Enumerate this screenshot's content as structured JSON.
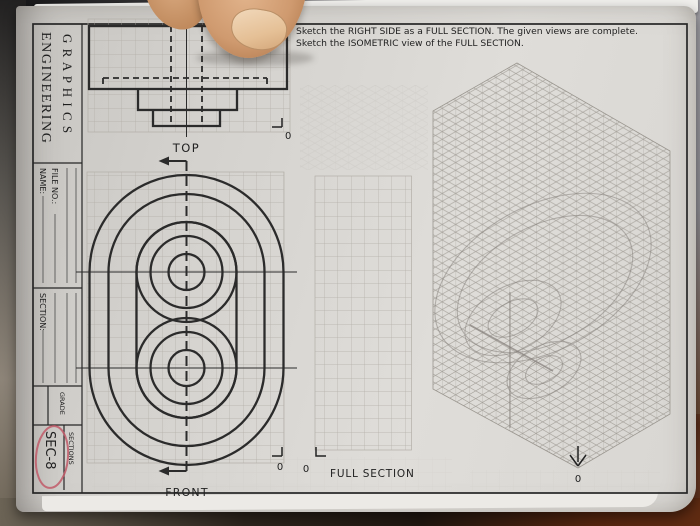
{
  "scene": {
    "kind": "photo of an engineering graphics worksheet page held open by a fingertip",
    "table_colors": {
      "top_left_dark": "#1a191b",
      "left_gray": "#6f6b66",
      "right_gray": "#a8a7ac",
      "bottom_brown": "#5f2b12",
      "bottom_dark": "#241b13"
    },
    "finger": {
      "skin": "#cf9a6f",
      "skin_light": "#e2b48c",
      "nail": "#eed6b8"
    }
  },
  "sheet": {
    "paper_color": "#d9d7d3",
    "border_color": "#262626",
    "line_color": "#2b2b2b",
    "grid_color": "#b2aea7",
    "iso_grid_color": "#a29e97",
    "pencil_color": "#837e79",
    "instructions": {
      "line1": "Sketch the RIGHT SIDE as a FULL SECTION.  The given views are complete.",
      "line2": "Sketch the ISOMETRIC view of the FULL SECTION."
    },
    "title_block": {
      "title_line1": "ENGINEERING",
      "title_line2": "G R A P H I C S",
      "name_label": "NAME:",
      "file_no_label": "FILE NO.:",
      "section_label": "SECTION:",
      "grade_label": "GRADE",
      "sec_value": "SEC-8",
      "sections_label": "SECTIONS",
      "highlight_color": "#c15a68"
    },
    "views": {
      "top": {
        "label": "TOP",
        "origin": "0"
      },
      "front": {
        "label": "FRONT",
        "origin": "0"
      },
      "full_section": {
        "label": "FULL SECTION",
        "origin": "0"
      },
      "isometric": {
        "origin": "0"
      }
    }
  }
}
